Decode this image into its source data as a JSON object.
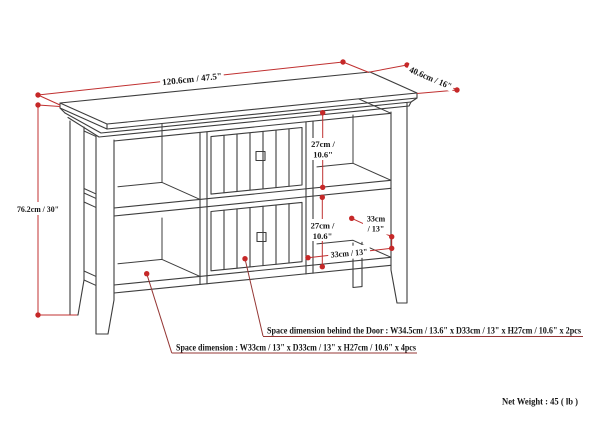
{
  "labels": {
    "width": "120.6cm / 47.5\"",
    "depth": "40.6cm / 16\"",
    "height": "76.2cm / 30\"",
    "upper_opening_h_1": "27cm /",
    "upper_opening_h_2": "10.6\"",
    "lower_opening_h_1": "27cm /",
    "lower_opening_h_2": "10.6\"",
    "shelf_depth_1": "33cm",
    "shelf_depth_2": "/ 13\"",
    "opening_width": "33cm / 13\"",
    "note_behind_door": "Space dimension behind the Door : W34.5cm / 13.6\" x D33cm / 13\" x H27cm / 10.6\" x 2pcs",
    "note_space": "Space dimension : W33cm / 13\" x D33cm / 13\" x H27cm / 10.6\" x 4pcs",
    "net_weight": "Net Weight : 45 ( lb )"
  },
  "colors": {
    "background": "#ffffff",
    "furniture_line": "#3d3d3d",
    "dimension_line": "#c03030",
    "dimension_dot": "#c62828",
    "note_line": "#953735",
    "text": "#151515"
  }
}
